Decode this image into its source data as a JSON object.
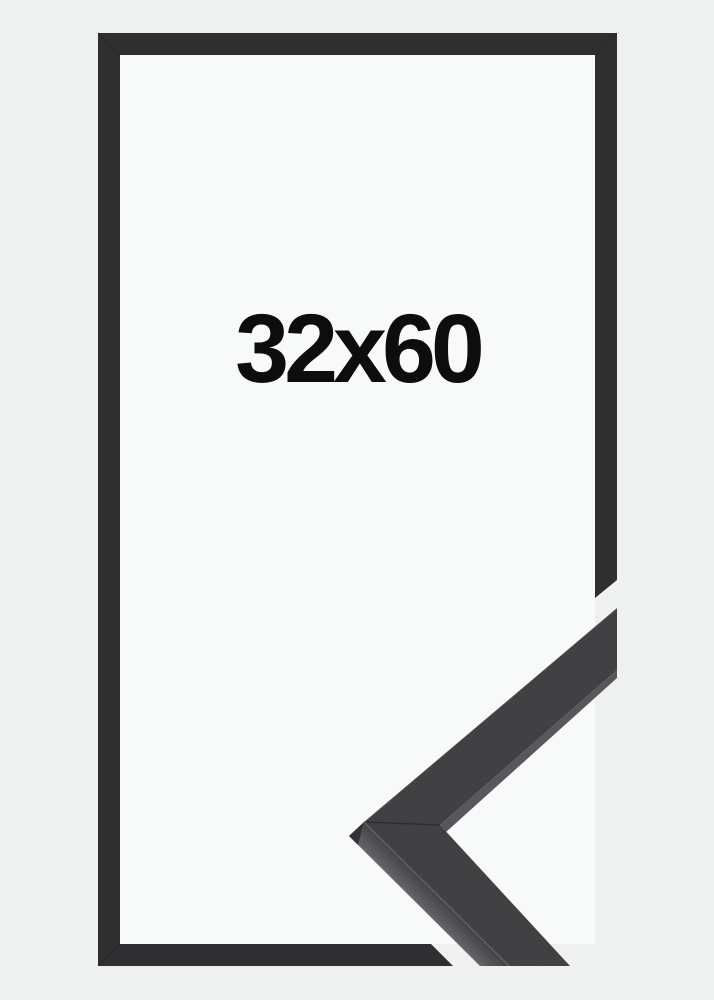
{
  "size_label": {
    "text": "32x60",
    "width_value": "32",
    "separator": "x",
    "height_value": "60"
  },
  "colors": {
    "background": "#eff0f0",
    "frame_opening": "#f8f9f9",
    "frame_border": "#2f2f32",
    "moulding_face": "#3b3b3e",
    "moulding_side_dark": "#3f3f43",
    "moulding_side_mid": "#5a5a60",
    "moulding_side_light": "#84848a",
    "moulding_edge_sliver": "#57575c",
    "moulding_corner_facet": "#2e2e31",
    "label_text": "#0d0d0d"
  }
}
